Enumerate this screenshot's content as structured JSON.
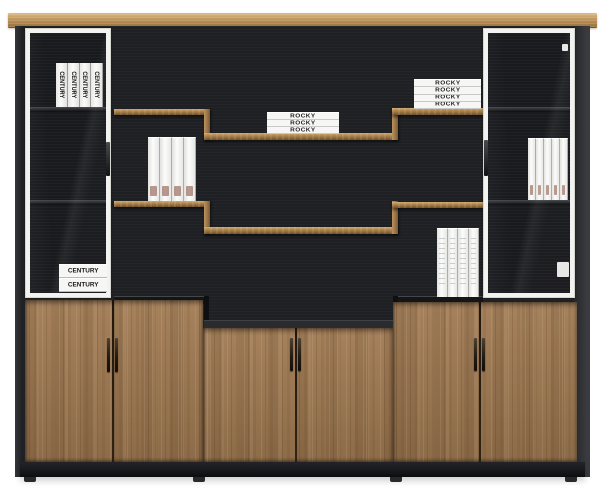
{
  "books": {
    "century_vertical": [
      "CENTURY",
      "CENTURY",
      "CENTURY",
      "CENTURY"
    ],
    "century_stacked": [
      "CENTURY",
      "CENTURY"
    ],
    "rocky_center": [
      "ROCKY",
      "ROCKY",
      "ROCKY"
    ],
    "rocky_upper_right": [
      "ROCKY",
      "ROCKY",
      "ROCKY",
      "ROCKY"
    ]
  },
  "counts": {
    "left_shelf_binders": 4,
    "right_cabinet_binders": 5,
    "bottom_right_binders": 4
  },
  "colors": {
    "background": "#ffffff",
    "wood_door": "#a07a52",
    "wood_top_board": "#c49a63",
    "panel_black": "#1f2023",
    "glass_frame_white": "#f2f2f0",
    "book_white": "#f6f6f4",
    "handle_dark": "#231c12"
  }
}
